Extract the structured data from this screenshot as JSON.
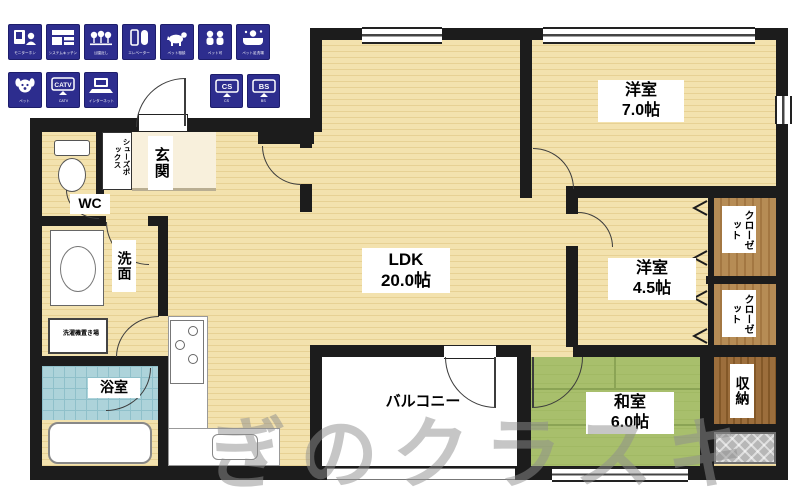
{
  "colors": {
    "wall": "#1c1c1c",
    "wood": "#f3e2ae",
    "tatami": "#a8bf6c",
    "bath_tile": "#add3da",
    "badge_navy": "#2d2d8e",
    "closet_wood": "#b68c55",
    "watermark_grey": "#8f8f8f"
  },
  "watermark": "ぎのクラスキ",
  "amenities": {
    "row1": [
      {
        "icon": "intercom",
        "caption": "モニターホン"
      },
      {
        "icon": "system-kitchen",
        "caption": "システムキッチン"
      },
      {
        "icon": "park",
        "caption": "公園近し"
      },
      {
        "icon": "elevator",
        "caption": "エレベーター"
      },
      {
        "icon": "pet-consult",
        "caption": "ペット相談"
      },
      {
        "icon": "pets-ok",
        "caption": "ペット可"
      },
      {
        "icon": "pet-wash",
        "caption": "ペット足洗場"
      }
    ],
    "row2": [
      {
        "icon": "dog",
        "caption": "ペット"
      },
      {
        "icon": "catv",
        "caption": "CATV",
        "screen": "CATV"
      },
      {
        "icon": "internet",
        "caption": "インターネット"
      }
    ],
    "row2b": [
      {
        "icon": "cs",
        "caption": "CS",
        "screen": "CS"
      },
      {
        "icon": "bs",
        "caption": "BS",
        "screen": "BS"
      }
    ]
  },
  "rooms": {
    "ldk": {
      "label": "LDK",
      "area": "20.0帖"
    },
    "western7": {
      "label": "洋室",
      "area": "7.0帖"
    },
    "western45": {
      "label": "洋室",
      "area": "4.5帖"
    },
    "japanese": {
      "label": "和室",
      "area": "6.0帖"
    },
    "balcony": {
      "label": "バルコニー"
    },
    "entrance": {
      "label": "玄関"
    },
    "shoe_box": {
      "label": "シューズボックス"
    },
    "wc": {
      "label": "WC"
    },
    "washroom": {
      "label": "洗面"
    },
    "laundry": {
      "label": "洗濯機置き場"
    },
    "bath": {
      "label": "浴室"
    },
    "closet1": {
      "label": "クローゼット"
    },
    "closet2": {
      "label": "クローゼット"
    },
    "storage": {
      "label": "収納"
    }
  }
}
